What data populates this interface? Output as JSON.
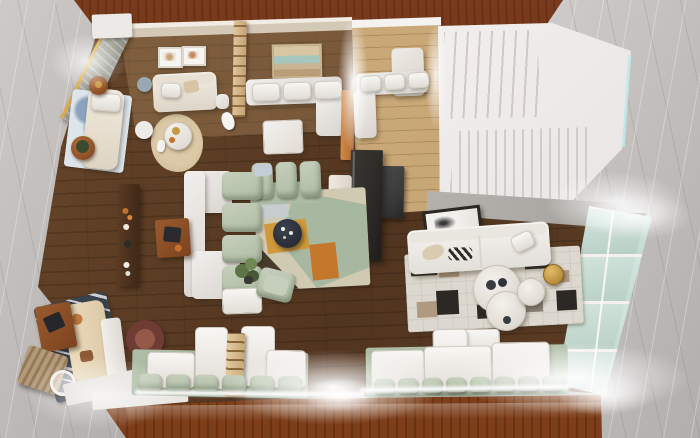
{
  "scene": {
    "title": "Top-down 3D render of an open-plan loft apartment model",
    "description": "Dollhouse-style overhead architectural rendering of a furnished open-plan apartment standing on a gray marble surface, framed by dark mahogany wood panels at the top and bottom. Dark walnut plank flooring, white and sage furniture, a white staircase at the upper right, a glazed wall at the right, and LED light strips glowing along the window benches.",
    "view": "top-down dollhouse cutaway",
    "visible_text": "none"
  },
  "palette": {
    "marble1": "#cdcac8",
    "marble2": "#b1aeac",
    "wood-top": "#7a3a1c",
    "wood-top-dark": "#5f2c11",
    "wood-bottom": "#8e4b22",
    "wood-bottom-light": "#a55f2e",
    "floor1": "#69482b",
    "floor2": "#523520",
    "floor-light": "#c3a171",
    "wall": "#d4c8b7",
    "wall-cap": "#f1ece4",
    "white-furn": "#f1efec",
    "white-shadow": "#d9d4cf",
    "sage": "#adbca4",
    "sage-light": "#c6cfbc",
    "cream": "#e9e0cf",
    "rug-base": "#d1cab3",
    "rug-sage": "#a8b79f",
    "mustard": "#d09a3c",
    "orange": "#c4762a",
    "rug-dark": "#463a2b",
    "navy": "#3a424e",
    "navy-stripe": "#cad0d6",
    "patch-base": "#ddd8cf",
    "patch-dark": "#2c2824",
    "patch-tan": "#af9a81",
    "blue-blot": "#8aa2bd",
    "glass": "#d9eae4",
    "glass-line": "#f6efef",
    "brass": "#c69a44",
    "wood-furn": "#8d4f26",
    "wood-dark": "#442b18",
    "ladder": "#d7ba8d",
    "partition": "#2f2c29",
    "appliance": "#3c3c3c",
    "ledge": "#b4b1ac",
    "stair": "#f0edec",
    "stair-line": "#cfcac7",
    "stair-cyan": "#c2e9ea",
    "yellow": "#e0a93e",
    "slab": "#e3e0db",
    "plant": "#5d7446",
    "plant-dark": "#3c4a30"
  },
  "rooms": [
    {
      "id": "lounge-left",
      "label": "Reading lounge",
      "furniture": [
        "cream daybed",
        "blue watercolor rug",
        "round wood side tables",
        "poufs",
        "round beige rug with side table"
      ]
    },
    {
      "id": "bedroom",
      "label": "Bedroom sitting area",
      "furniture": [
        "white loveseat",
        "two framed prints",
        "dog figurine"
      ]
    },
    {
      "id": "dining-nook",
      "label": "Dining nook",
      "furniture": [
        "landscape artwork",
        "white corner bench",
        "white table",
        "orange wood cabinet",
        "slat ladder screen"
      ]
    },
    {
      "id": "hall",
      "label": "Hallway / kitchen nook",
      "furniture": [
        "white corner bench",
        "white cabinet",
        "dark appliance block",
        "display shelf",
        "dark glass partition"
      ]
    },
    {
      "id": "stairwell",
      "label": "Staircase",
      "furniture": [
        "upper flight",
        "landing",
        "lower flight with slat railing"
      ]
    },
    {
      "id": "living-room",
      "label": "Living room",
      "furniture": [
        "sage sectional sofa",
        "white platform seats",
        "geometric rug",
        "round dark coffee table",
        "walnut media console",
        "wood side table",
        "sage armchair",
        "potted plant"
      ]
    },
    {
      "id": "family-room",
      "label": "Family room",
      "furniture": [
        "white sofa",
        "patchwork cowhide rug",
        "round white coffee tables",
        "brass stool",
        "leaning framed artwork"
      ]
    },
    {
      "id": "window-bench",
      "label": "Window bench seating",
      "furniture": [
        "white seat cushions",
        "sage pillows",
        "wooden ladder"
      ]
    },
    {
      "id": "corner-lounge",
      "label": "Corner lounge",
      "furniture": [
        "tan sofa",
        "striped navy rug",
        "wood coffee table",
        "folding chair",
        "marble bench",
        "burgundy swivel chair",
        "wire basket"
      ]
    },
    {
      "id": "glass-wall",
      "label": "Glazed wall",
      "furniture": []
    }
  ],
  "counts": {
    "bench_pillows_left": 6,
    "bench_pillows_right": 8,
    "dining_cushions": 3,
    "hall_cushions": 3,
    "sectional_back_cushions": 3,
    "sectional_side_cushions": 4,
    "glass_panes": 4
  }
}
